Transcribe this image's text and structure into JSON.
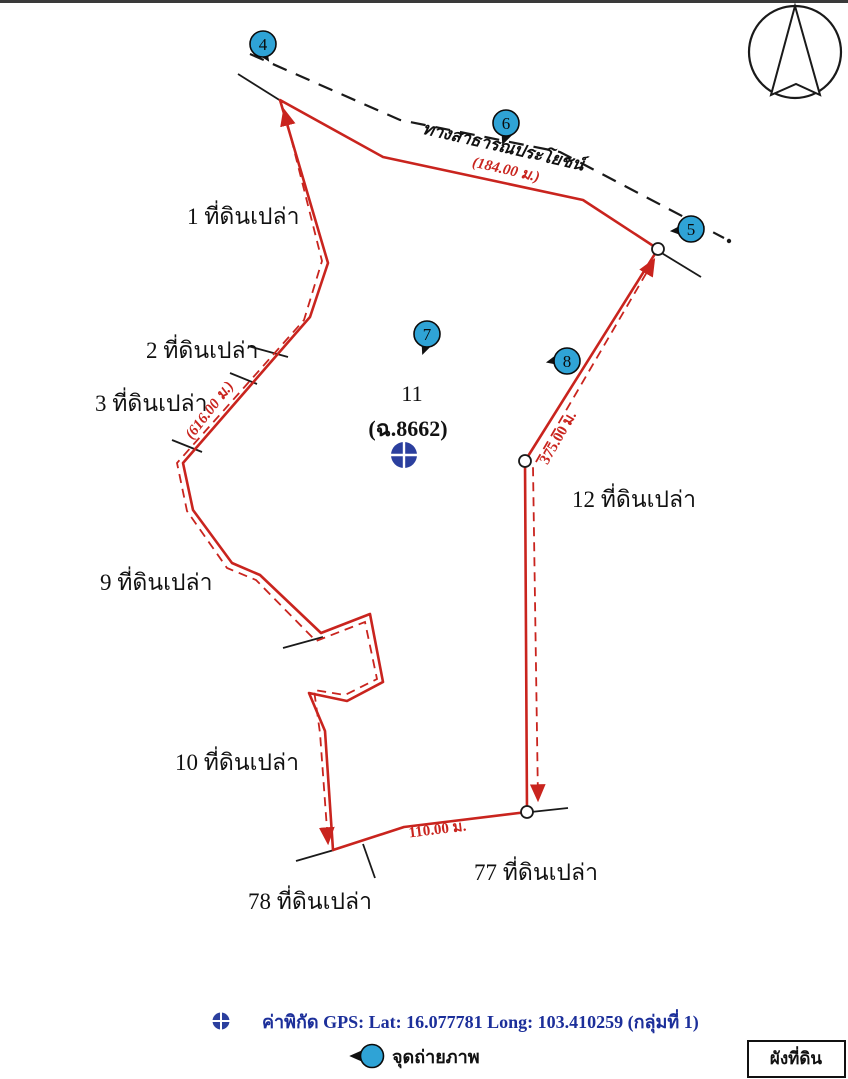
{
  "map": {
    "parcel": {
      "number": "11",
      "deed": "(ฉ.8662)"
    },
    "road": {
      "name": "ทางสาธารณประโยชน์",
      "length": "(184.00 ม.)"
    },
    "dimensions": {
      "west": "(616.00 ม.)",
      "east": "375.00 ม.",
      "south": "110.00 ม."
    },
    "neighbors": {
      "n1": "1 ที่ดินเปล่า",
      "n2": "2 ที่ดินเปล่า",
      "n3": "3 ที่ดินเปล่า",
      "n9": "9 ที่ดินเปล่า",
      "n10": "10 ที่ดินเปล่า",
      "n12": "12 ที่ดินเปล่า",
      "n77": "77 ที่ดินเปล่า",
      "n78": "78 ที่ดินเปล่า"
    },
    "photo_points": {
      "p4": "4",
      "p5": "5",
      "p6": "6",
      "p7": "7",
      "p8": "8"
    }
  },
  "legend": {
    "gps_text": "ค่าพิกัด GPS:  Lat: 16.077781  Long: 103.410259 (กลุ่มที่ 1)",
    "gps_lat": "16.077781",
    "gps_long": "103.410259",
    "photo_label": "จุดถ่ายภาพ"
  },
  "title_box": "ผังที่ดิน",
  "icons": {
    "north_arrow": "compass-north-arrow-icon",
    "gps_point": "blue-circle-cross-icon",
    "photo_point": "blue-numbered-circle-icon"
  },
  "colors": {
    "boundary_red": "#C9241E",
    "marker_blue": "#2FA3D6",
    "gps_blue": "#2B3F9E",
    "legend_blue": "#1C2F9A",
    "line_black": "#1A1A1A"
  }
}
